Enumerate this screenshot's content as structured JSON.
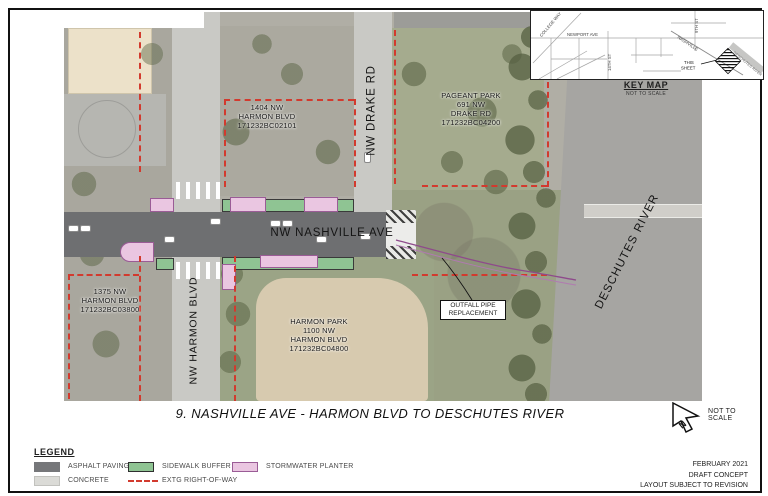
{
  "map": {
    "labels": {
      "parcel_1404": {
        "lines": [
          "1404 NW",
          "HARMON BLVD",
          "171232BC02101"
        ]
      },
      "pageant_park": {
        "lines": [
          "PAGEANT PARK",
          "691 NW",
          "DRAKE RD",
          "171232BC04200"
        ]
      },
      "parcel_1375": {
        "lines": [
          "1375 NW",
          "HARMON BLVD",
          "171232BC03800"
        ]
      },
      "harmon_park": {
        "lines": [
          "HARMON PARK",
          "1100 NW",
          "HARMON BLVD",
          "171232BC04800"
        ]
      },
      "nashville_ave": "NW NASHVILLE AVE",
      "drake_rd": "NW DRAKE RD",
      "harmon_blvd": "NW HARMON BLVD",
      "deschutes_river": "DESCHUTES RIVER",
      "outfall": {
        "lines": [
          "OUTFALL PIPE",
          "REPLACEMENT"
        ]
      }
    }
  },
  "key_map": {
    "title": "KEY MAP",
    "subtitle": "NOT TO SCALE",
    "this_sheet_1": "THIS",
    "this_sheet_2": "SHEET",
    "streets": {
      "college_way": "COLLEGE WAY",
      "newport_ave": "NEWPORT AVE",
      "fourteenth_st": "14TH ST",
      "ninth_st": "9TH ST",
      "nashville": "NASHVILLE",
      "deschutes_river": "DESCHUTES RIVER"
    }
  },
  "title_block": {
    "sheet_title": "9. NASHVILLE AVE - HARMON BLVD TO DESCHUTES RIVER",
    "north_label": "N",
    "scale_note": "NOT TO SCALE",
    "date": "FEBRUARY 2021",
    "status": "DRAFT CONCEPT",
    "note": "LAYOUT SUBJECT TO REVISION"
  },
  "legend": {
    "title": "LEGEND",
    "items": [
      {
        "label": "ASPHALT PAVING",
        "color": "#76777a"
      },
      {
        "label": "CONCRETE",
        "color": "#dbdbd7"
      },
      {
        "label": "SIDEWALK BUFFER",
        "color": "#8fc493"
      },
      {
        "label": "EXTG RIGHT-OF-WAY",
        "color": "#d23a2e"
      },
      {
        "label": "STORMWATER PLANTER",
        "color": "#eac6e1"
      }
    ]
  }
}
